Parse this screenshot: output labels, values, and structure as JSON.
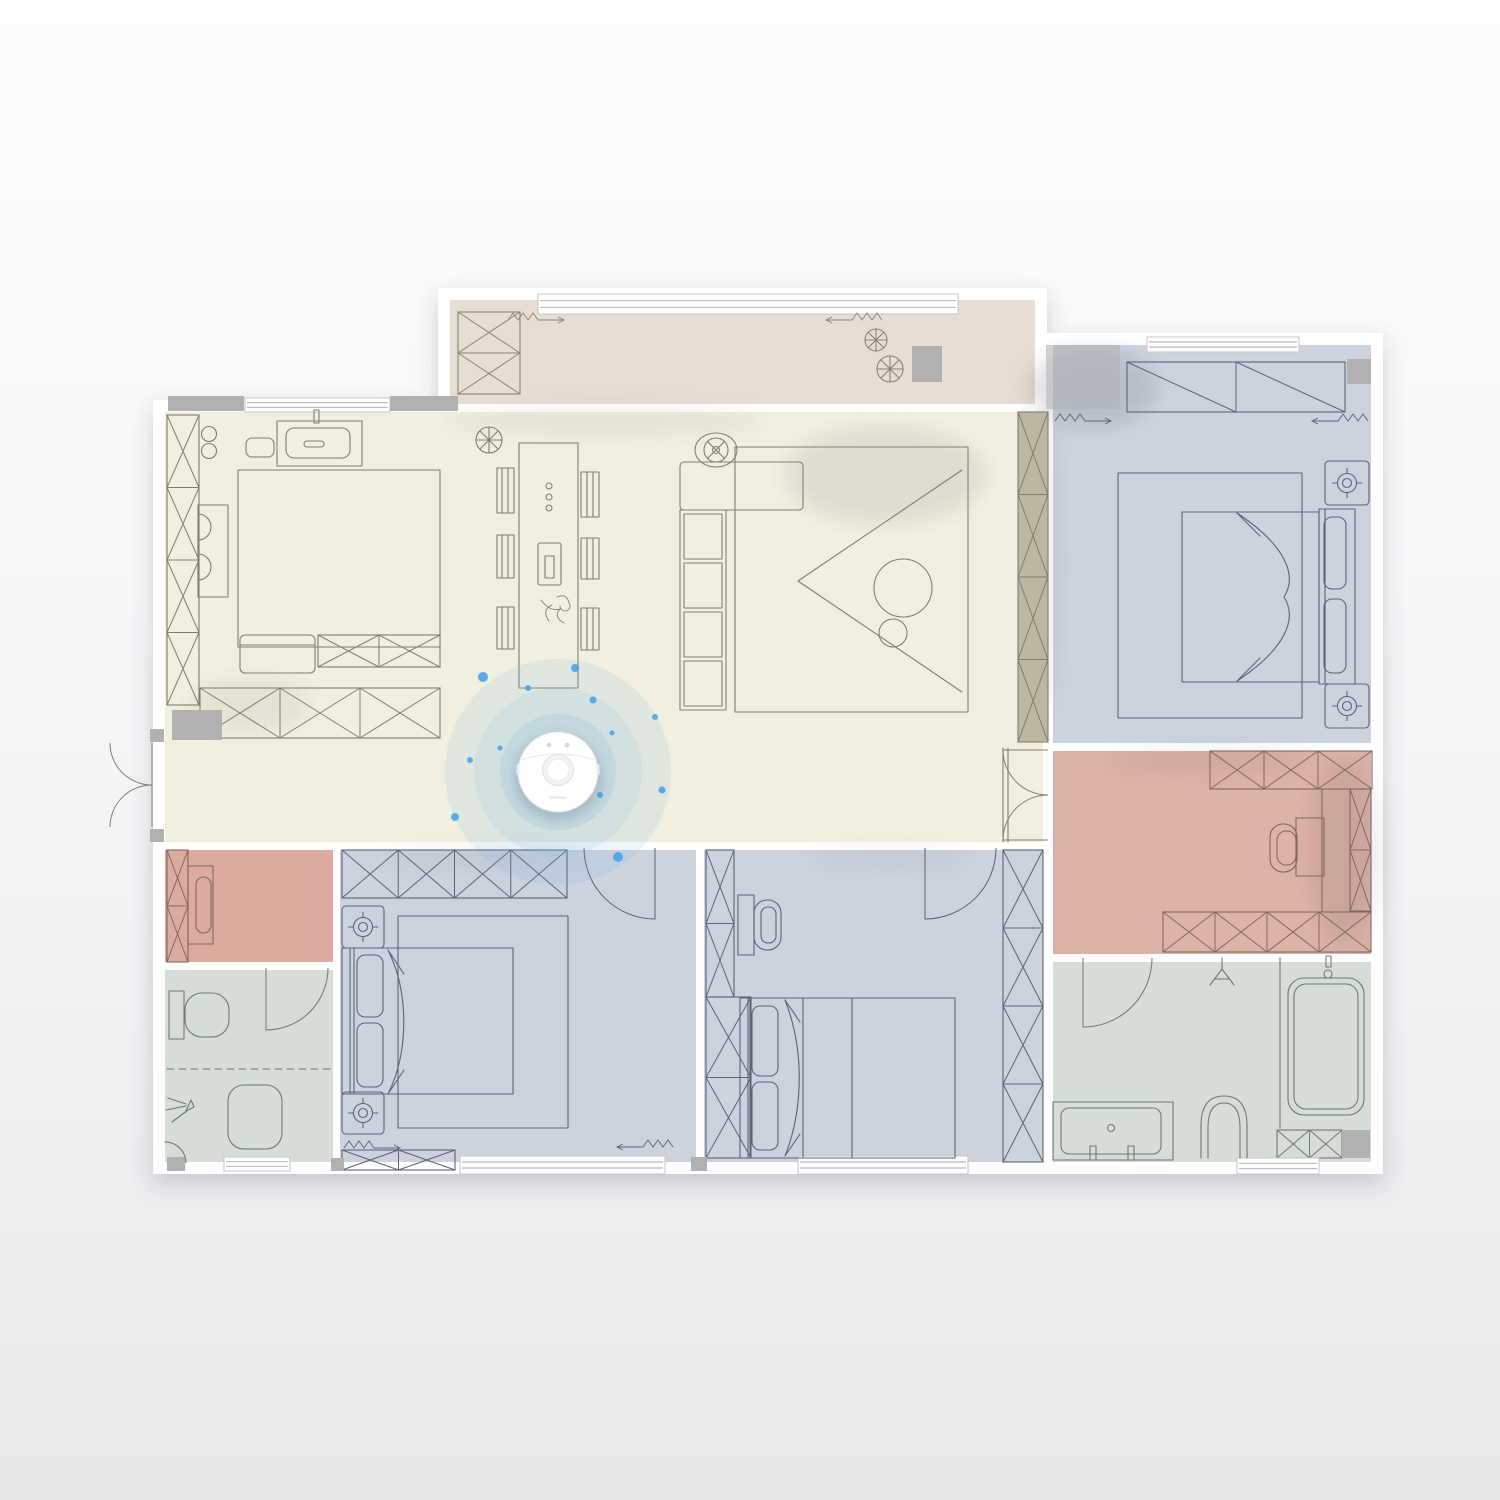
{
  "scene": {
    "label": "robot-vacuum-floor-plan",
    "canvas_w": 1500,
    "canvas_h": 1500
  },
  "palette": {
    "page_top": "#fdfdfe",
    "page_bottom": "#e8e8ea",
    "wall": "#ffffff",
    "window_frame": "#c7c7cb",
    "window_line": "#a9a9af",
    "cream": "#f1efdf",
    "balcony": "#e7ddd4",
    "blue": "#ccd3df",
    "pink_dressing": "#ddb2a8",
    "pink_study": "#dcaa9e",
    "green": "#d6dcd6",
    "line_cream": "#827e6c",
    "line_blue": "#5c6374",
    "line_pink": "#7e6a61",
    "line_green": "#6f7a6f",
    "line_balcony": "#8b8174",
    "gray_block": "#b2b1b2",
    "cabinet_beige": "#bcb7a3",
    "ripple": "#76aede",
    "dot": "#3fa0ea",
    "shadow": "#3a3f4a",
    "robot_body": "#ffffff",
    "robot_edge": "#e2e2e4"
  },
  "rooms": [
    {
      "id": "balcony",
      "name": "Balcony",
      "rect": [
        450,
        300,
        585,
        104
      ],
      "color": "balcony"
    },
    {
      "id": "living-kitchen",
      "name": "Living / Dining / Kitchen",
      "rect": [
        165,
        412,
        878,
        430
      ],
      "color": "cream"
    },
    {
      "id": "bedroom-master",
      "name": "Master Bedroom",
      "rect": [
        1053,
        345,
        318,
        398
      ],
      "color": "blue"
    },
    {
      "id": "dressing-room",
      "name": "Dressing Room",
      "rect": [
        1053,
        751,
        318,
        203
      ],
      "color": "pink_dressing"
    },
    {
      "id": "bathroom-right",
      "name": "En-suite Bathroom",
      "rect": [
        1053,
        962,
        318,
        200
      ],
      "color": "green"
    },
    {
      "id": "bedroom-left",
      "name": "Bedroom Lower Left",
      "rect": [
        340,
        850,
        356,
        312
      ],
      "color": "blue"
    },
    {
      "id": "bedroom-middle",
      "name": "Bedroom Lower Middle",
      "rect": [
        704,
        850,
        339,
        312
      ],
      "color": "blue"
    },
    {
      "id": "study",
      "name": "Study Nook",
      "rect": [
        165,
        850,
        168,
        112
      ],
      "color": "pink_study"
    },
    {
      "id": "bathroom-left",
      "name": "Bathroom Lower Left",
      "rect": [
        165,
        970,
        168,
        192
      ],
      "color": "green"
    }
  ],
  "robot": {
    "transform": "translate(558,772)",
    "cx": 558,
    "cy": 772,
    "r": 40,
    "ripples": [
      {
        "r": 113,
        "o": 0.13
      },
      {
        "r": 84,
        "o": 0.13
      },
      {
        "r": 58,
        "o": 0.17
      }
    ],
    "dots": [
      {
        "x": 575,
        "y": 668,
        "r": 4
      },
      {
        "x": 483,
        "y": 677,
        "r": 5
      },
      {
        "x": 593,
        "y": 700,
        "r": 3.5
      },
      {
        "x": 655,
        "y": 717,
        "r": 3
      },
      {
        "x": 455,
        "y": 817,
        "r": 4
      },
      {
        "x": 600,
        "y": 795,
        "r": 3
      },
      {
        "x": 662,
        "y": 790,
        "r": 3.5
      },
      {
        "x": 618,
        "y": 857,
        "r": 5
      },
      {
        "x": 528,
        "y": 688,
        "r": 3
      },
      {
        "x": 500,
        "y": 748,
        "r": 2.5
      },
      {
        "x": 612,
        "y": 733,
        "r": 2.5
      },
      {
        "x": 470,
        "y": 760,
        "r": 3
      }
    ]
  },
  "cabinets": [
    {
      "r": [
        167,
        415,
        32,
        290
      ],
      "n": 4,
      "style": "x",
      "ln": "line_cream"
    },
    {
      "r": [
        318,
        635,
        122,
        32
      ],
      "n": 2,
      "style": "x",
      "ln": "line_cream"
    },
    {
      "r": [
        200,
        688,
        240,
        50
      ],
      "n": 3,
      "style": "x",
      "ln": "line_cream"
    },
    {
      "r": [
        1018,
        412,
        30,
        330
      ],
      "n": 4,
      "style": "x",
      "ln": "line_cream",
      "fill": "cabinet_beige"
    },
    {
      "r": [
        458,
        312,
        62,
        82
      ],
      "n": 2,
      "style": "x",
      "ln": "line_balcony"
    },
    {
      "r": [
        1127,
        362,
        218,
        50
      ],
      "n": 2,
      "style": "diag",
      "ln": "line_blue"
    },
    {
      "r": [
        1210,
        751,
        162,
        38
      ],
      "n": 3,
      "style": "x",
      "ln": "line_pink"
    },
    {
      "r": [
        1350,
        789,
        21,
        122
      ],
      "n": 2,
      "style": "x",
      "ln": "line_pink"
    },
    {
      "r": [
        1163,
        912,
        208,
        40
      ],
      "n": 4,
      "style": "x",
      "ln": "line_pink"
    },
    {
      "r": [
        342,
        850,
        225,
        48
      ],
      "n": 4,
      "style": "x",
      "ln": "line_blue"
    },
    {
      "r": [
        342,
        1150,
        113,
        20
      ],
      "n": 2,
      "style": "x",
      "ln": "line_blue"
    },
    {
      "r": [
        706,
        850,
        28,
        147
      ],
      "n": 2,
      "style": "x",
      "ln": "line_blue"
    },
    {
      "r": [
        706,
        997,
        45,
        161
      ],
      "n": 2,
      "style": "x",
      "ln": "line_blue"
    },
    {
      "r": [
        1003,
        850,
        40,
        312
      ],
      "n": 4,
      "style": "x",
      "ln": "line_blue"
    },
    {
      "r": [
        167,
        850,
        21,
        112
      ],
      "n": 2,
      "style": "x",
      "ln": "line_pink"
    },
    {
      "r": [
        1277,
        1130,
        65,
        28
      ],
      "n": 2,
      "style": "x",
      "ln": "line_green"
    }
  ],
  "windows": [
    [
      538,
      294,
      420,
      20
    ],
    [
      245,
      398,
      145,
      14
    ],
    [
      1147,
      337,
      152,
      15
    ],
    [
      460,
      1156,
      205,
      18
    ],
    [
      798,
      1156,
      170,
      18
    ],
    [
      1237,
      1158,
      82,
      16
    ],
    [
      224,
      1157,
      66,
      14
    ]
  ],
  "gray_blocks": [
    [
      168,
      396,
      76,
      15,
      1
    ],
    [
      390,
      396,
      68,
      15,
      1
    ],
    [
      172,
      710,
      50,
      30,
      1
    ],
    [
      912,
      346,
      30,
      36,
      1
    ],
    [
      1046,
      345,
      74,
      64,
      0.55
    ],
    [
      1347,
      359,
      24,
      25,
      1
    ],
    [
      1342,
      1130,
      28,
      28,
      1
    ],
    [
      167,
      1157,
      18,
      14,
      1
    ],
    [
      331,
      1158,
      13,
      13,
      1
    ],
    [
      691,
      1157,
      16,
      14,
      1
    ],
    [
      150,
      729,
      14,
      13,
      1
    ],
    [
      150,
      829,
      14,
      13,
      1
    ]
  ],
  "doors": [
    {
      "hx": 152,
      "hy": 743,
      "r": 42,
      "a1": 90,
      "a2": 180,
      "sw": 1,
      "ln": "line_cream"
    },
    {
      "hx": 152,
      "hy": 827,
      "r": 42,
      "a1": 270,
      "a2": 180,
      "sw": 0,
      "ln": "line_cream"
    },
    {
      "hx": 1048,
      "hy": 750,
      "r": 45,
      "a1": 180,
      "a2": 90,
      "sw": 0,
      "ln": "line_cream"
    },
    {
      "hx": 1048,
      "hy": 840,
      "r": 45,
      "a1": 180,
      "a2": 270,
      "sw": 1,
      "ln": "line_cream"
    },
    {
      "hx": 655,
      "hy": 848,
      "r": 71,
      "a1": 90,
      "a2": 180,
      "sw": 1,
      "ln": "line_blue"
    },
    {
      "hx": 925,
      "hy": 848,
      "r": 71,
      "a1": 90,
      "a2": 0,
      "sw": 0,
      "ln": "line_blue"
    },
    {
      "hx": 1083,
      "hy": 958,
      "r": 69,
      "a1": 90,
      "a2": 0,
      "sw": 0,
      "ln": "line_green"
    },
    {
      "hx": 266,
      "hy": 968,
      "r": 62,
      "a1": 90,
      "a2": 0,
      "sw": 0,
      "ln": "line_green"
    }
  ],
  "nightstands": [
    [
      1325,
      461,
      44
    ],
    [
      1325,
      684,
      44
    ],
    [
      342,
      906,
      42
    ],
    [
      342,
      1092,
      42
    ]
  ],
  "curtains": [
    {
      "x": 508,
      "y": 320,
      "d": 1,
      "ln": "line_balcony"
    },
    {
      "x": 882,
      "y": 320,
      "d": -1,
      "ln": "line_balcony"
    },
    {
      "x": 1055,
      "y": 421,
      "d": 1,
      "ln": "line_blue"
    },
    {
      "x": 1368,
      "y": 421,
      "d": -1,
      "ln": "line_blue"
    },
    {
      "x": 344,
      "y": 1148,
      "d": 1,
      "ln": "line_blue"
    },
    {
      "x": 673,
      "y": 1147,
      "d": -1,
      "ln": "line_blue"
    }
  ],
  "shadows": [
    [
      885,
      475,
      100,
      48,
      0.1
    ],
    [
      1092,
      388,
      66,
      40,
      0.14
    ],
    [
      1345,
      852,
      36,
      95,
      0.1
    ],
    [
      605,
      420,
      160,
      16,
      0.06
    ],
    [
      1210,
      760,
      100,
      14,
      0.07
    ],
    [
      250,
      705,
      60,
      26,
      0.07
    ],
    [
      480,
      858,
      100,
      12,
      0.06
    ],
    [
      890,
      858,
      80,
      12,
      0.06
    ],
    [
      1048,
      560,
      14,
      150,
      0.07
    ]
  ]
}
